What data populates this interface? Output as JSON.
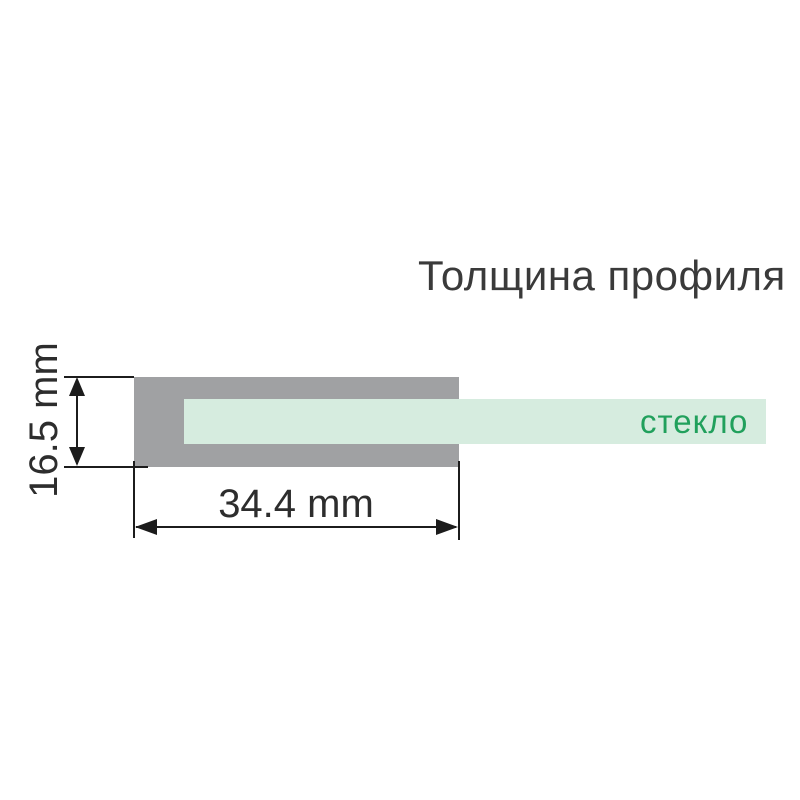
{
  "title": "Толщина профиля",
  "profile": {
    "glass_label": "стекло",
    "height_label": "16.5 mm",
    "width_label": "34.4 mm"
  },
  "colors": {
    "background": "#ffffff",
    "profile_gray": "#a0a1a3",
    "glass_mint": "#d6ecdf",
    "glass_green": "#21a05c",
    "line_black": "#1c1c1c",
    "text_dark": "#2d2d2d",
    "title_color": "#3a3a3a"
  }
}
